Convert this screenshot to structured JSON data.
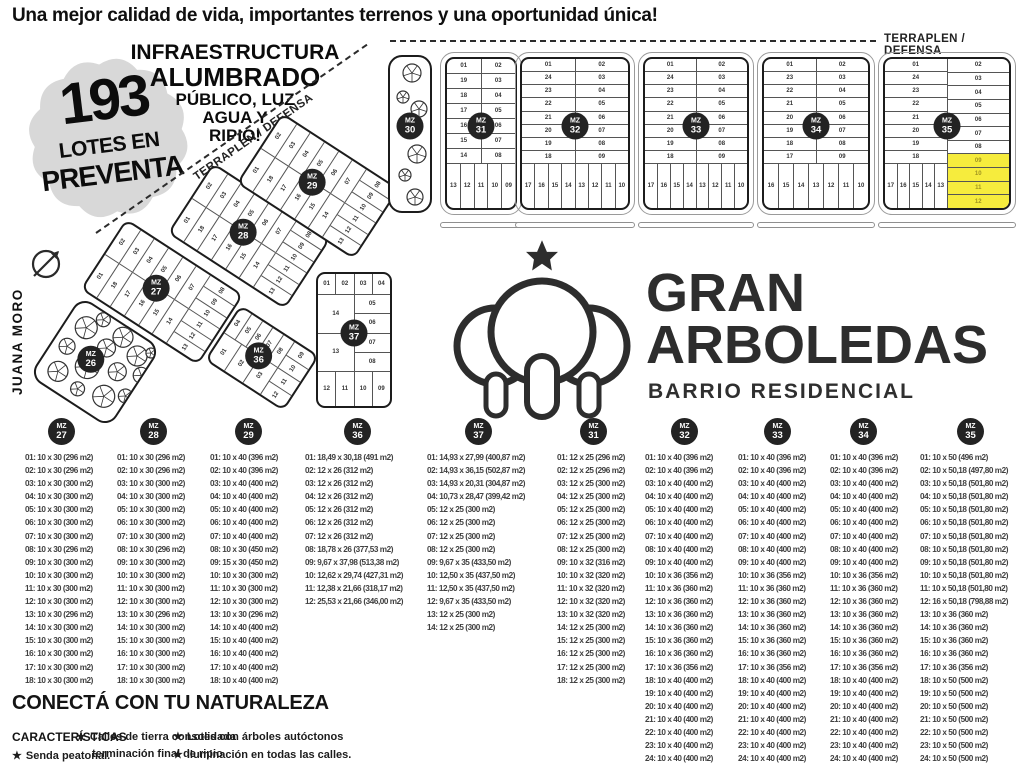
{
  "header": {
    "tagline": "Una mejor calidad de vida,  importantes terrenos y una oportunidad única!"
  },
  "badge": {
    "number": "193",
    "line1": "LOTES EN",
    "line2": "PREVENTA"
  },
  "infra": {
    "lines": [
      "INFRAESTRUCTURA",
      "ALUMBRADO",
      "PÚBLICO, LUZ",
      "AGUA Y",
      "RIPIO!"
    ]
  },
  "logo": {
    "line1": "GRAN",
    "line2": "ARBOLEDAS",
    "subtitle": "BARRIO RESIDENCIAL"
  },
  "map": {
    "terraplen_label": "TERRAPLEN / DEFENSA",
    "street_label": "JUANA MORO",
    "mz_prefix": "MZ",
    "highlight_color": "#f6ec3d",
    "badge_color": "#232323",
    "top_blocks": [
      {
        "num": "31",
        "left": [
          "01",
          "19",
          "18",
          "17",
          "16",
          "15",
          "14"
        ],
        "right": [
          "02",
          "03",
          "04",
          "05",
          "06",
          "07",
          "08"
        ],
        "bottom": [
          "13",
          "12",
          "11",
          "10",
          "09"
        ]
      },
      {
        "num": "32",
        "left": [
          "01",
          "24",
          "23",
          "22",
          "21",
          "20",
          "19",
          "18"
        ],
        "right": [
          "02",
          "03",
          "04",
          "05",
          "06",
          "07",
          "08",
          "09"
        ],
        "bottom": [
          "17",
          "16",
          "15",
          "14",
          "13",
          "12",
          "11",
          "10"
        ]
      },
      {
        "num": "33",
        "left": [
          "01",
          "24",
          "23",
          "22",
          "21",
          "20",
          "19",
          "18"
        ],
        "right": [
          "02",
          "03",
          "04",
          "05",
          "06",
          "07",
          "08",
          "09"
        ],
        "bottom": [
          "17",
          "16",
          "15",
          "14",
          "13",
          "12",
          "11",
          "10"
        ]
      },
      {
        "num": "34",
        "left": [
          "01",
          "23",
          "22",
          "21",
          "20",
          "19",
          "18",
          "17"
        ],
        "right": [
          "02",
          "03",
          "04",
          "05",
          "06",
          "07",
          "08",
          "09"
        ],
        "bottom": [
          "16",
          "15",
          "14",
          "13",
          "12",
          "11",
          "10"
        ]
      },
      {
        "num": "35",
        "left": [
          "01",
          "24",
          "23",
          "22",
          "21",
          "20",
          "19",
          "18"
        ],
        "right": [
          "02",
          "03",
          "04",
          "05",
          "06",
          "07",
          "08"
        ],
        "right_highlight": [
          "09",
          "10",
          "11",
          "12"
        ],
        "bottom": [
          "17",
          "16",
          "15",
          "14",
          "13"
        ]
      }
    ],
    "diag_blocks": [
      {
        "num": "27",
        "left": [
          "01",
          "18",
          "17",
          "16",
          "15",
          "14"
        ],
        "right": [
          "02",
          "03",
          "04",
          "05",
          "06",
          "07"
        ],
        "bottom": [
          "13",
          "12",
          "11",
          "10",
          "09",
          "08"
        ]
      },
      {
        "num": "28",
        "left": [
          "01",
          "18",
          "17",
          "16",
          "15",
          "14"
        ],
        "right": [
          "02",
          "03",
          "04",
          "05",
          "06",
          "07"
        ],
        "bottom": [
          "13",
          "12",
          "11",
          "10",
          "09",
          "08"
        ]
      },
      {
        "num": "29",
        "left": [
          "01",
          "18",
          "17",
          "16",
          "15",
          "14"
        ],
        "right": [
          "02",
          "03",
          "04",
          "05",
          "06",
          "07"
        ],
        "bottom": [
          "13",
          "12",
          "11",
          "10",
          "09",
          "08"
        ]
      },
      {
        "num": "36",
        "left": [
          "01",
          "02",
          "03"
        ],
        "right": [
          "04",
          "05",
          "06",
          "07",
          "08"
        ],
        "bottom": [
          "12",
          "11",
          "10",
          "09"
        ]
      },
      {
        "num": "37",
        "top": [
          "01",
          "02",
          "03",
          "04"
        ],
        "left": [
          "14",
          "13"
        ],
        "right": [
          "05",
          "06",
          "07",
          "08"
        ],
        "bottom": [
          "12",
          "11",
          "10",
          "09"
        ]
      }
    ],
    "tree_blocks": [
      {
        "num": "26"
      },
      {
        "num": "30"
      }
    ]
  },
  "listings": {
    "columns": [
      {
        "mz": "27",
        "items": [
          "01: 10 x 30 (296 m2)",
          "02: 10 x 30 (296 m2)",
          "03: 10 x 30 (300 m2)",
          "04: 10 x 30 (300 m2)",
          "05: 10 x 30 (300 m2)",
          "06: 10 x 30 (300 m2)",
          "07: 10 x 30 (300 m2)",
          "08: 10 x 30 (296 m2)",
          "09: 10 x 30 (300 m2)",
          "10: 10 x 30 (300 m2)",
          "11: 10 x 30 (300 m2)",
          "12: 10 x 30 (300 m2)",
          "13: 10 x 30 (296 m2)",
          "14: 10 x 30 (300 m2)",
          "15: 10 x 30 (300 m2)",
          "16: 10 x 30 (300 m2)",
          "17: 10 x 30 (300 m2)",
          "18: 10 x 30 (300 m2)"
        ]
      },
      {
        "mz": "28",
        "items": [
          "01: 10 x 30 (296 m2)",
          "02: 10 x 30 (296 m2)",
          "03: 10 x 30 (300 m2)",
          "04: 10 x 30 (300 m2)",
          "05: 10 x 30 (300 m2)",
          "06: 10 x 30 (300 m2)",
          "07: 10 x 30 (300 m2)",
          "08: 10 x 30 (296 m2)",
          "09: 10 x 30 (300 m2)",
          "10: 10 x 30 (300 m2)",
          "11: 10 x 30 (300 m2)",
          "12: 10 x 30 (300 m2)",
          "13: 10 x 30 (296 m2)",
          "14: 10 x 30 (300 m2)",
          "15: 10 x 30 (300 m2)",
          "16: 10 x 30 (300 m2)",
          "17: 10 x 30 (300 m2)",
          "18: 10 x 30 (300 m2)"
        ]
      },
      {
        "mz": "29",
        "items": [
          "01: 10 x 40 (396 m2)",
          "02: 10 x 40 (396 m2)",
          "03: 10 x 40 (400 m2)",
          "04: 10 x 40 (400 m2)",
          "05: 10 x 40 (400 m2)",
          "06: 10 x 40 (400 m2)",
          "07: 10 x 40 (400 m2)",
          "08: 10 x 30 (450 m2)",
          "09: 15 x 30 (450 m2)",
          "10: 10 x 30 (300 m2)",
          "11: 10 x 30 (300 m2)",
          "12: 10 x 30 (300 m2)",
          "13: 10 x 30 (296 m2)",
          "14: 10 x 40 (400 m2)",
          "15: 10 x 40 (400 m2)",
          "16: 10 x 40 (400 m2)",
          "17: 10 x 40 (400 m2)",
          "18: 10 x 40 (400 m2)"
        ]
      },
      {
        "mz": "36",
        "items": [
          "01: 18,49 x 30,18 (491 m2)",
          "02: 12 x 26 (312 m2)",
          "03: 12 x 26 (312 m2)",
          "04: 12 x 26 (312 m2)",
          "05: 12 x 26 (312 m2)",
          "06: 12 x 26 (312 m2)",
          "07: 12 x 26 (312 m2)",
          "08: 18,78 x 26 (377,53 m2)",
          "09: 9,67 x 37,98 (513,38 m2)",
          "10: 12,62 x 29,74 (427,31 m2)",
          "11: 12,38 x 21,66 (318,17 m2)",
          "12: 25,53 x 21,66 (346,00 m2)"
        ]
      },
      {
        "mz": "37",
        "items": [
          "01: 14,93 x 27,99 (400,87 m2)",
          "02: 14,93 x 36,15 (502,87 m2)",
          "03: 14,93 x 20,31 (304,87 m2)",
          "04: 10,73 x 28,47 (399,42 m2)",
          "05: 12 x 25 (300 m2)",
          "06: 12 x 25 (300 m2)",
          "07: 12 x 25 (300 m2)",
          "08: 12 x 25 (300 m2)",
          "09: 9,67 x 35 (433,50 m2)",
          "10: 12,50 x 35 (437,50 m2)",
          "11: 12,50 x 35 (437,50 m2)",
          "12: 9,67 x 35 (433,50 m2)",
          "13: 12 x 25 (300 m2)",
          "14: 12 x 25 (300 m2)"
        ]
      },
      {
        "mz": "31",
        "items": [
          "01: 12 x 25 (296 m2)",
          "02: 12 x 25 (296 m2)",
          "03: 12 x 25 (300 m2)",
          "04: 12 x 25 (300 m2)",
          "05: 12 x 25 (300 m2)",
          "06: 12 x 25 (300 m2)",
          "07: 12 x 25 (300 m2)",
          "08: 12 x 25 (300 m2)",
          "09: 10 x 32 (316 m2)",
          "10: 10 x 32 (320 m2)",
          "11: 10 x 32 (320 m2)",
          "12: 10 x 32 (320 m2)",
          "13: 10 x 32 (320 m2)",
          "14: 12 x 25 (300 m2)",
          "15: 12 x 25 (300 m2)",
          "16: 12 x 25 (300 m2)",
          "17: 12 x 25 (300 m2)",
          "18: 12 x 25 (300 m2)"
        ]
      },
      {
        "mz": "32",
        "items": [
          "01: 10 x 40 (396 m2)",
          "02: 10 x 40 (396 m2)",
          "03: 10 x 40 (400 m2)",
          "04: 10 x 40 (400 m2)",
          "05: 10 x 40 (400 m2)",
          "06: 10 x 40 (400 m2)",
          "07: 10 x 40 (400 m2)",
          "08: 10 x 40 (400 m2)",
          "09: 10 x 40 (400 m2)",
          "10: 10 x 36 (356 m2)",
          "11: 10 x 36 (360 m2)",
          "12: 10 x 36 (360 m2)",
          "13: 10 x 36 (360 m2)",
          "14: 10 x 36 (360 m2)",
          "15: 10 x 36 (360 m2)",
          "16: 10 x 36 (360 m2)",
          "17: 10 x 36 (356 m2)",
          "18: 10 x 40 (400 m2)",
          "19: 10 x 40 (400 m2)",
          "20: 10 x 40 (400 m2)",
          "21: 10 x 40 (400 m2)",
          "22: 10 x 40 (400 m2)",
          "23: 10 x 40 (400 m2)",
          "24: 10 x 40 (400 m2)"
        ]
      },
      {
        "mz": "33",
        "items": [
          "01: 10 x 40 (396 m2)",
          "02: 10 x 40 (396 m2)",
          "03: 10 x 40 (400 m2)",
          "04: 10 x 40 (400 m2)",
          "05: 10 x 40 (400 m2)",
          "06: 10 x 40 (400 m2)",
          "07: 10 x 40 (400 m2)",
          "08: 10 x 40 (400 m2)",
          "09: 10 x 40 (400 m2)",
          "10: 10 x 36 (356 m2)",
          "11: 10 x 36 (360 m2)",
          "12: 10 x 36 (360 m2)",
          "13: 10 x 36 (360 m2)",
          "14: 10 x 36 (360 m2)",
          "15: 10 x 36 (360 m2)",
          "16: 10 x 36 (360 m2)",
          "17: 10 x 36 (356 m2)",
          "18: 10 x 40 (400 m2)",
          "19: 10 x 40 (400 m2)",
          "20: 10 x 40 (400 m2)",
          "21: 10 x 40 (400 m2)",
          "22: 10 x 40 (400 m2)",
          "23: 10 x 40 (400 m2)",
          "24: 10 x 40 (400 m2)"
        ]
      },
      {
        "mz": "34",
        "items": [
          "01: 10 x 40 (396 m2)",
          "02: 10 x 40 (396 m2)",
          "03: 10 x 40 (400 m2)",
          "04: 10 x 40 (400 m2)",
          "05: 10 x 40 (400 m2)",
          "06: 10 x 40 (400 m2)",
          "07: 10 x 40 (400 m2)",
          "08: 10 x 40 (400 m2)",
          "09: 10 x 40 (400 m2)",
          "10: 10 x 36 (356 m2)",
          "11: 10 x 36 (360 m2)",
          "12: 10 x 36 (360 m2)",
          "13: 10 x 36 (360 m2)",
          "14: 10 x 36 (360 m2)",
          "15: 10 x 36 (360 m2)",
          "16: 10 x 36 (360 m2)",
          "17: 10 x 36 (356 m2)",
          "18: 10 x 40 (400 m2)",
          "19: 10 x 40 (400 m2)",
          "20: 10 x 40 (400 m2)",
          "21: 10 x 40 (400 m2)",
          "22: 10 x 40 (400 m2)",
          "23: 10 x 40 (400 m2)",
          "24: 10 x 40 (400 m2)"
        ]
      },
      {
        "mz": "35",
        "items": [
          "01: 10 x 50 (496 m2)",
          "02: 10 x 50,18 (497,80 m2)",
          "03: 10 x 50,18 (501,80 m2)",
          "04: 10 x 50,18 (501,80 m2)",
          "05: 10 x 50,18 (501,80 m2)",
          "06: 10 x 50,18 (501,80 m2)",
          "07: 10 x 50,18 (501,80 m2)",
          "08: 10 x 50,18 (501,80 m2)",
          "09: 10 x 50,18 (501,80 m2)",
          "10: 10 x 50,18 (501,80 m2)",
          "11: 10 x 50,18 (501,80 m2)",
          "12: 16 x 50,18 (798,88 m2)",
          "13: 10 x 36 (360 m2)",
          "14: 10 x 36 (360 m2)",
          "15: 10 x 36 (360 m2)",
          "16: 10 x 36 (360 m2)",
          "17: 10 x 36 (356 m2)",
          "18: 10 x 50 (500 m2)",
          "19: 10 x 50 (500 m2)",
          "20: 10 x 50 (500 m2)",
          "21: 10 x 50 (500 m2)",
          "22: 10 x 50 (500 m2)",
          "23: 10 x 50 (500 m2)",
          "24: 10 x 50 (500 m2)"
        ]
      }
    ]
  },
  "footer": {
    "title": "CONECTÁ CON TU NATURALEZA",
    "caracteristicas": "CARACTERÍSTICAS",
    "bullet": "★",
    "f1": "Senda peatonal.",
    "f2a": "Calles de tierra consolidada",
    "f2b": "terminación final de ripio",
    "f3": "Lotes con árboles autóctonos",
    "f4": "Iluminación en todas las calles."
  }
}
